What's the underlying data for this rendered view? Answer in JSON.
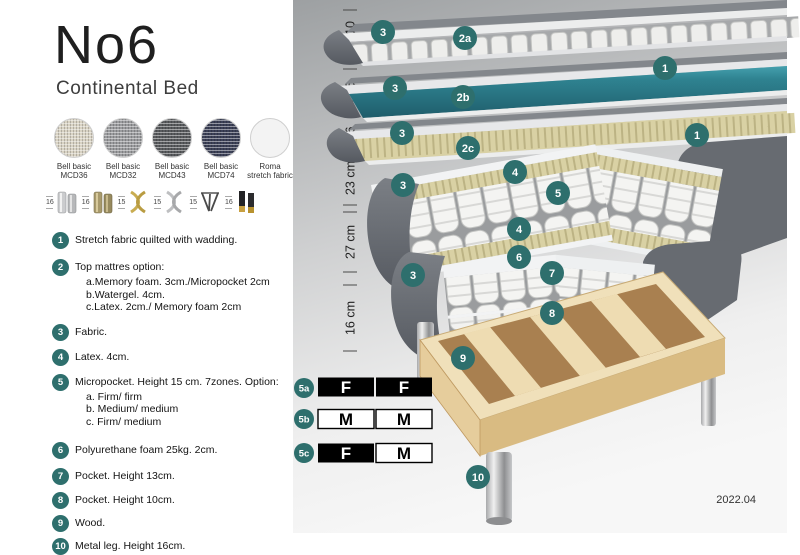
{
  "product": {
    "title": "No6",
    "subtitle": "Continental Bed"
  },
  "fabrics": [
    {
      "line1": "Bell basic",
      "line2": "MCD36",
      "color": "#d9d3c4"
    },
    {
      "line1": "Bell basic",
      "line2": "MCD32",
      "color": "#9b9c9e"
    },
    {
      "line1": "Bell basic",
      "line2": "MCD43",
      "color": "#595b5e"
    },
    {
      "line1": "Bell basic",
      "line2": "MCD74",
      "color": "#3c4157"
    },
    {
      "line1": "Roma",
      "line2": "stretch fabric",
      "color": "#f3f3f3"
    }
  ],
  "legs": [
    {
      "height": "16",
      "style": "cylinder-chrome"
    },
    {
      "height": "16",
      "style": "cylinder-brass"
    },
    {
      "height": "15",
      "style": "cross-gold"
    },
    {
      "height": "15",
      "style": "cross-silver"
    },
    {
      "height": "15",
      "style": "hairpin"
    },
    {
      "height": "16",
      "style": "black-gold"
    }
  ],
  "features": [
    {
      "num": "1",
      "text": "Stretch fabric quilted with wadding."
    },
    {
      "num": "2",
      "text": "Top mattres option:",
      "sub": [
        "a.Memory foam. 3cm./Micropocket 2cm",
        "b.Watergel. 4cm.",
        "c.Latex. 2cm./ Memory foam 2cm"
      ]
    },
    {
      "num": "3",
      "text": "Fabric."
    },
    {
      "num": "4",
      "text": "Latex. 4cm."
    },
    {
      "num": "5",
      "text": "Micropocket. Height 15 cm. 7zones. Option:",
      "sub": [
        "a. Firm/ firm",
        "b. Medium/ medium",
        "c. Firm/ medium"
      ]
    },
    {
      "num": "6",
      "text": "Polyurethane foam 25kg. 2cm."
    },
    {
      "num": "7",
      "text": "Pocket. Height 13cm."
    },
    {
      "num": "8",
      "text": "Pocket. Height 10cm."
    },
    {
      "num": "9",
      "text": "Wood."
    },
    {
      "num": "10",
      "text": "Metal leg. Height 16cm."
    }
  ],
  "diagram": {
    "measurements": [
      "10",
      "6",
      "6",
      "23 cm",
      "27 cm",
      "16 cm"
    ],
    "callouts": [
      "3",
      "2a",
      "1",
      "3",
      "2b",
      "1",
      "3",
      "2c",
      "3",
      "4",
      "5",
      "4",
      "6",
      "7",
      "3",
      "8",
      "9",
      "10"
    ],
    "firmness": [
      {
        "id": "5a",
        "cells": [
          {
            "value": "F",
            "filled": true
          },
          {
            "value": "F",
            "filled": true
          }
        ]
      },
      {
        "id": "5b",
        "cells": [
          {
            "value": "M",
            "filled": false
          },
          {
            "value": "M",
            "filled": false
          }
        ]
      },
      {
        "id": "5c",
        "cells": [
          {
            "value": "F",
            "filled": true
          },
          {
            "value": "M",
            "filled": false
          }
        ]
      }
    ],
    "version": "2022.04"
  },
  "colors": {
    "accent_teal": "#2e6f6d",
    "layer_teal": "#2f7f8d",
    "dark_fabric": "#6b6f76",
    "foam_khaki": "#d9d1a4",
    "wood": "#e3cb97"
  }
}
